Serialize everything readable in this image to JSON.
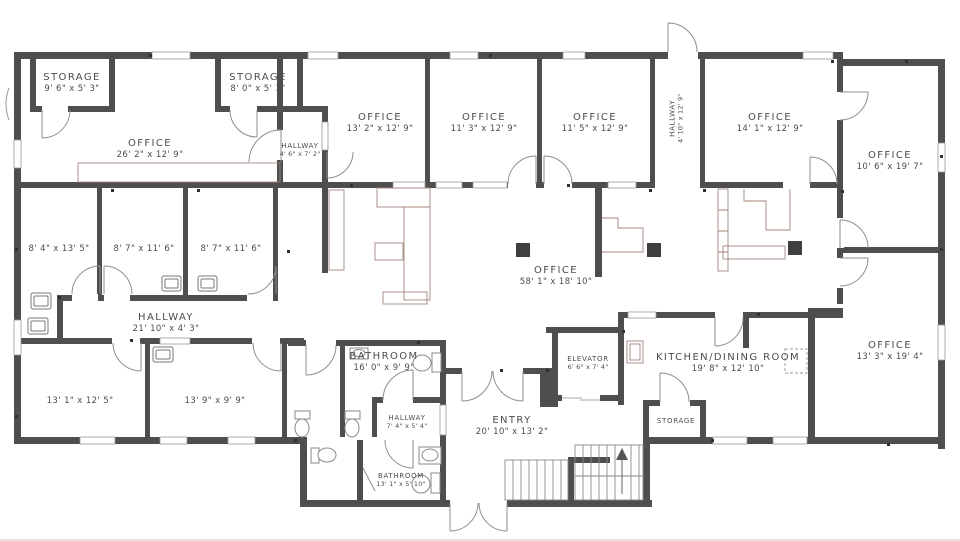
{
  "palette": {
    "wall": "#4e4e4e",
    "door_arc": "#8e8e8e",
    "furniture": "#a3847c",
    "fixture": "#8a8a8a",
    "text": "#4c4c4c",
    "column": "#3f3f3f"
  },
  "rooms": {
    "storage_nw": {
      "name": "STORAGE",
      "dims": "9' 6\" x 5' 3\""
    },
    "storage_n": {
      "name": "STORAGE",
      "dims": "8' 0\" x 5' 3\""
    },
    "office_26": {
      "name": "OFFICE",
      "dims": "26' 2\" x 12' 9\""
    },
    "hallway_46": {
      "name": "HALLWAY",
      "dims": "4' 6\" x 7' 2\""
    },
    "office_13_2": {
      "name": "OFFICE",
      "dims": "13' 2\" x 12' 9\""
    },
    "office_11_3": {
      "name": "OFFICE",
      "dims": "11' 3\" x 12' 9\""
    },
    "office_11_5": {
      "name": "OFFICE",
      "dims": "11' 5\" x 12' 9\""
    },
    "hallway_410": {
      "name": "HALLWAY",
      "dims": "4' 10\" x 12' 9\""
    },
    "office_14_1": {
      "name": "OFFICE",
      "dims": "14' 1\" x 12' 9\""
    },
    "office_10_6": {
      "name": "OFFICE",
      "dims": "10' 6\" x 19' 7\""
    },
    "room_8_4": {
      "dims": "8' 4\" x 13' 5\""
    },
    "room_8_7a": {
      "dims": "8' 7\" x 11' 6\""
    },
    "room_8_7b": {
      "dims": "8' 7\" x 11' 6\""
    },
    "office_58": {
      "name": "OFFICE",
      "dims": "58' 1\" x 18' 10\""
    },
    "hallway_21": {
      "name": "HALLWAY",
      "dims": "21' 10\" x 4' 3\""
    },
    "room_13_1": {
      "dims": "13' 1\" x 12' 5\""
    },
    "room_13_9": {
      "dims": "13' 9\" x 9' 9\""
    },
    "bathroom_16": {
      "name": "BATHROOM",
      "dims": "16' 0\" x 9' 9\""
    },
    "hallway_7": {
      "name": "HALLWAY",
      "dims": "7' 4\" x 5' 4\""
    },
    "entry": {
      "name": "ENTRY",
      "dims": "20' 10\" x 13' 2\""
    },
    "elevator": {
      "name": "ELEVATOR",
      "dims": "6' 6\" x 7' 4\""
    },
    "kitchen": {
      "name": "KITCHEN/DINING ROOM",
      "dims": "19' 8\" x 12' 10\""
    },
    "storage_s": {
      "name": "STORAGE"
    },
    "office_13_3": {
      "name": "OFFICE",
      "dims": "13' 3\" x 19' 4\""
    },
    "bathroom_13": {
      "name": "BATHROOM",
      "dims": "13' 1\" x 5' 10\""
    }
  }
}
